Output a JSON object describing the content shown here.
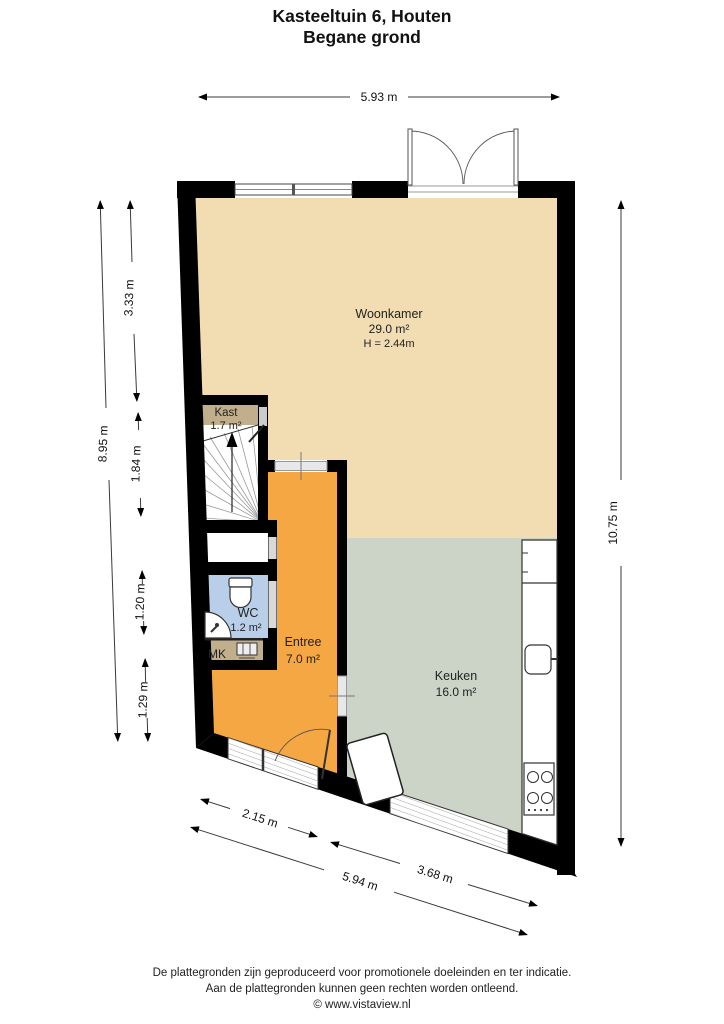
{
  "title": {
    "line1": "Kasteeltuin 6, Houten",
    "line2": "Begane grond"
  },
  "rooms": {
    "woonkamer": {
      "name": "Woonkamer",
      "area": "29.0 m²",
      "ceiling_height": "H = 2.44m",
      "color": "#f2dcb2"
    },
    "kast": {
      "name": "Kast",
      "area": "1.7 m²",
      "color": "#c1ae8d"
    },
    "wc": {
      "name": "WC",
      "area": "1.2 m²",
      "color": "#b9cfe9"
    },
    "mk": {
      "name": "MK",
      "color": "#c1ae8d"
    },
    "entree": {
      "name": "Entree",
      "area": "7.0 m²",
      "color": "#f4a742"
    },
    "keuken": {
      "name": "Keuken",
      "area": "16.0 m²",
      "color": "#cbd4c7"
    }
  },
  "dimensions": {
    "top_width": "5.93 m",
    "left_total": "8.95 m",
    "left_seg_1": "3.33 m",
    "left_seg_2": "1.84 m",
    "left_seg_3": "1.20 m",
    "left_seg_4": "1.29 m",
    "right_height": "10.75 m",
    "bottom_entree": "2.15 m",
    "bottom_keuken": "3.68 m",
    "bottom_total": "5.94 m"
  },
  "footer": {
    "line1": "De plattegronden zijn geproduceerd voor promotionele doeleinden en ter indicatie.",
    "line2": "Aan de plattegronden kunnen geen rechten worden ontleend.",
    "line3": "© www.vistaview.nl"
  },
  "colors": {
    "wall": "#000000",
    "dimension": "#3a3a3a"
  }
}
